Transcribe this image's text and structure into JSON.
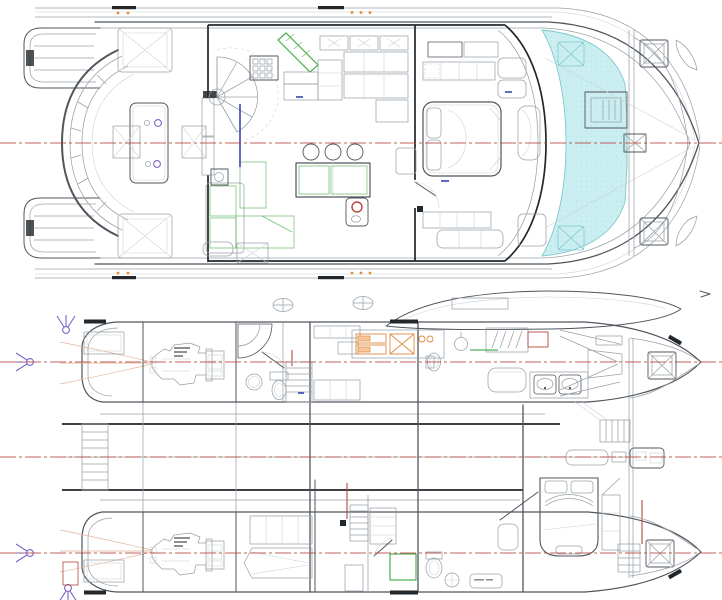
{
  "plans": {
    "upper_deck": {
      "aria_label": "catamaran main deck plan"
    },
    "lower_deck": {
      "aria_label": "catamaran lower deck hulls plan"
    }
  },
  "colors": {
    "page-bg": "#ffffff",
    "line-main": "#50565c",
    "line-light": "#9aa1a7",
    "line-faint": "#ccd2d6",
    "line-dark": "#22272b",
    "accent-red": "#b5473c",
    "accent-teal-fill": "#cbeef1",
    "accent-teal-line": "#7fc9ce",
    "accent-green": "#4caf50",
    "accent-green-fill": "#eef8ee",
    "accent-orange": "#de8a3c",
    "accent-orange-fill": "#f6c69b",
    "accent-purple": "#7d63c9",
    "accent-blue": "#3a46b4",
    "hull-fill": "#ffffff",
    "faint-orange": "#e4b49a"
  }
}
